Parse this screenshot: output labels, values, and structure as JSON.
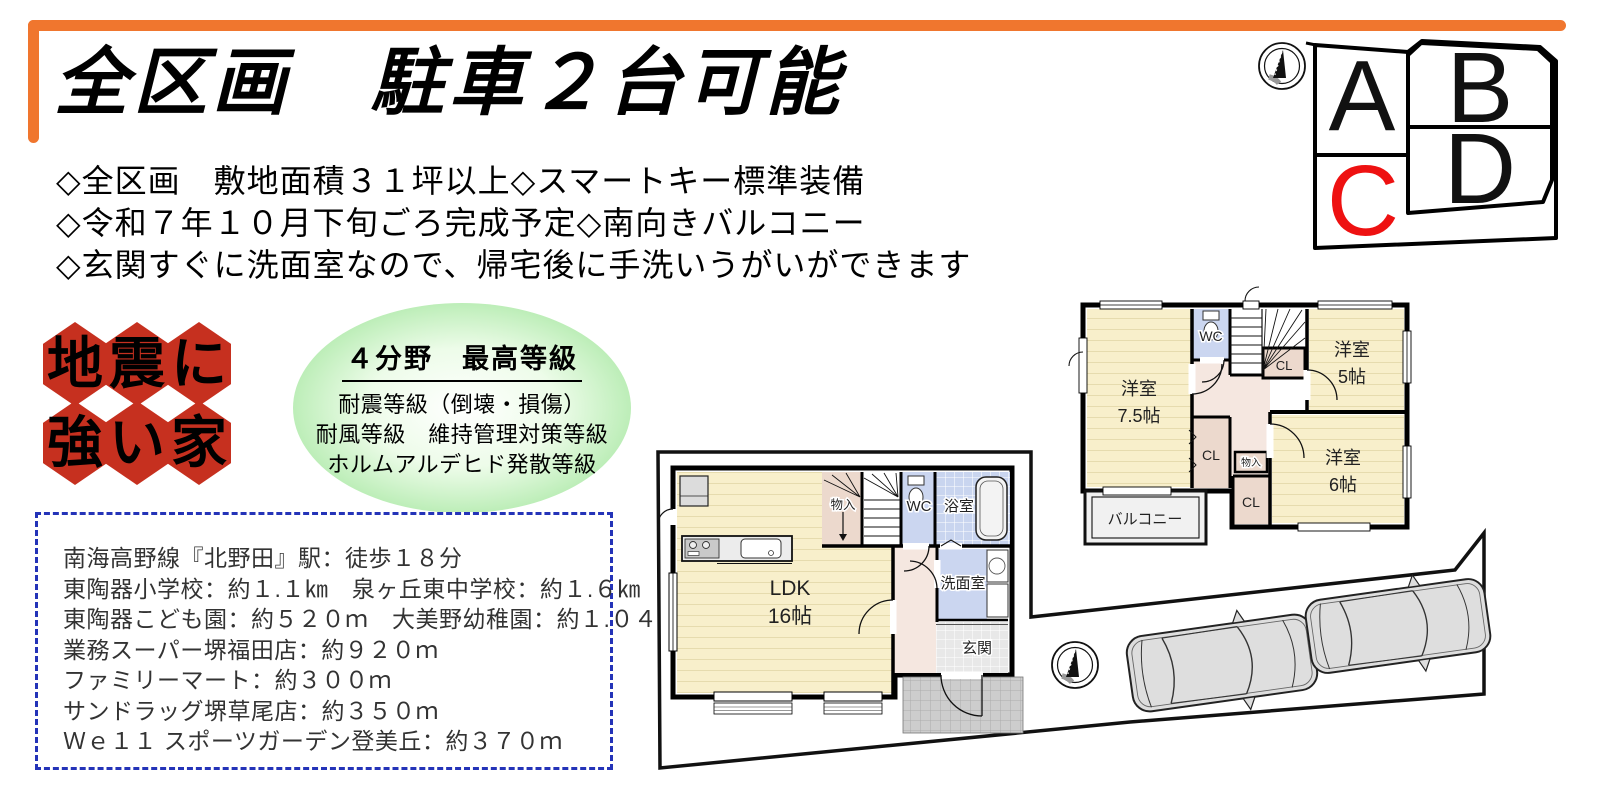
{
  "flyer": {
    "accent_orange": "#F0762E",
    "title": "全区画　駐車２台可能",
    "features": [
      "◇全区画　敷地面積３１坪以上◇スマートキー標準装備",
      "◇令和７年１０月下旬ごろ完成予定◇南向きバルコニー",
      "◇玄関すぐに洗面室なので、帰宅後に手洗いうがいができます"
    ]
  },
  "quake_logo": {
    "hex_color": "#C6301F",
    "chars": [
      "地",
      "震",
      "に",
      "強",
      "い",
      "家"
    ]
  },
  "grade_badge": {
    "bg": "#A6E7A1",
    "title": "４分野　最高等級",
    "lines": [
      "耐震等級（倒壊・損傷）",
      "耐風等級　維持管理対策等級",
      "ホルムアルデヒド発散等級"
    ]
  },
  "access_box": {
    "border_color": "#2433B8",
    "lines": [
      "南海高野線『北野田』駅：徒歩１８分",
      "東陶器小学校：約１.１㎞　泉ヶ丘東中学校：約１.６㎞",
      "東陶器こども園：約５２０ｍ　大美野幼稚園：約１.０４㎞",
      "業務スーパー堺福田店：約９２０ｍ",
      "ファミリーマート：約３００ｍ",
      "サンドラッグ堺草尾店：約３５０ｍ",
      "Ｗｅ１１ スポーツガーデン登美丘：約３７０ｍ"
    ]
  },
  "lot_map": {
    "lots": [
      {
        "label": "A",
        "color": "#111111"
      },
      {
        "label": "B",
        "color": "#111111"
      },
      {
        "label": "C",
        "color": "#EE1111"
      },
      {
        "label": "D",
        "color": "#111111"
      }
    ]
  },
  "floor_plan_1f": {
    "ldk": "LDK",
    "ldk_size": "16帖",
    "storage": "物入",
    "wc": "WC",
    "bath": "浴室",
    "washroom": "洗面室",
    "entrance": "玄関"
  },
  "floor_plan_2f": {
    "yoshitsu": "洋室",
    "size_75": "7.5帖",
    "size_5": "5帖",
    "size_6": "6帖",
    "wc": "WC",
    "cl": "CL",
    "storage": "物入",
    "balcony": "バルコニー"
  }
}
